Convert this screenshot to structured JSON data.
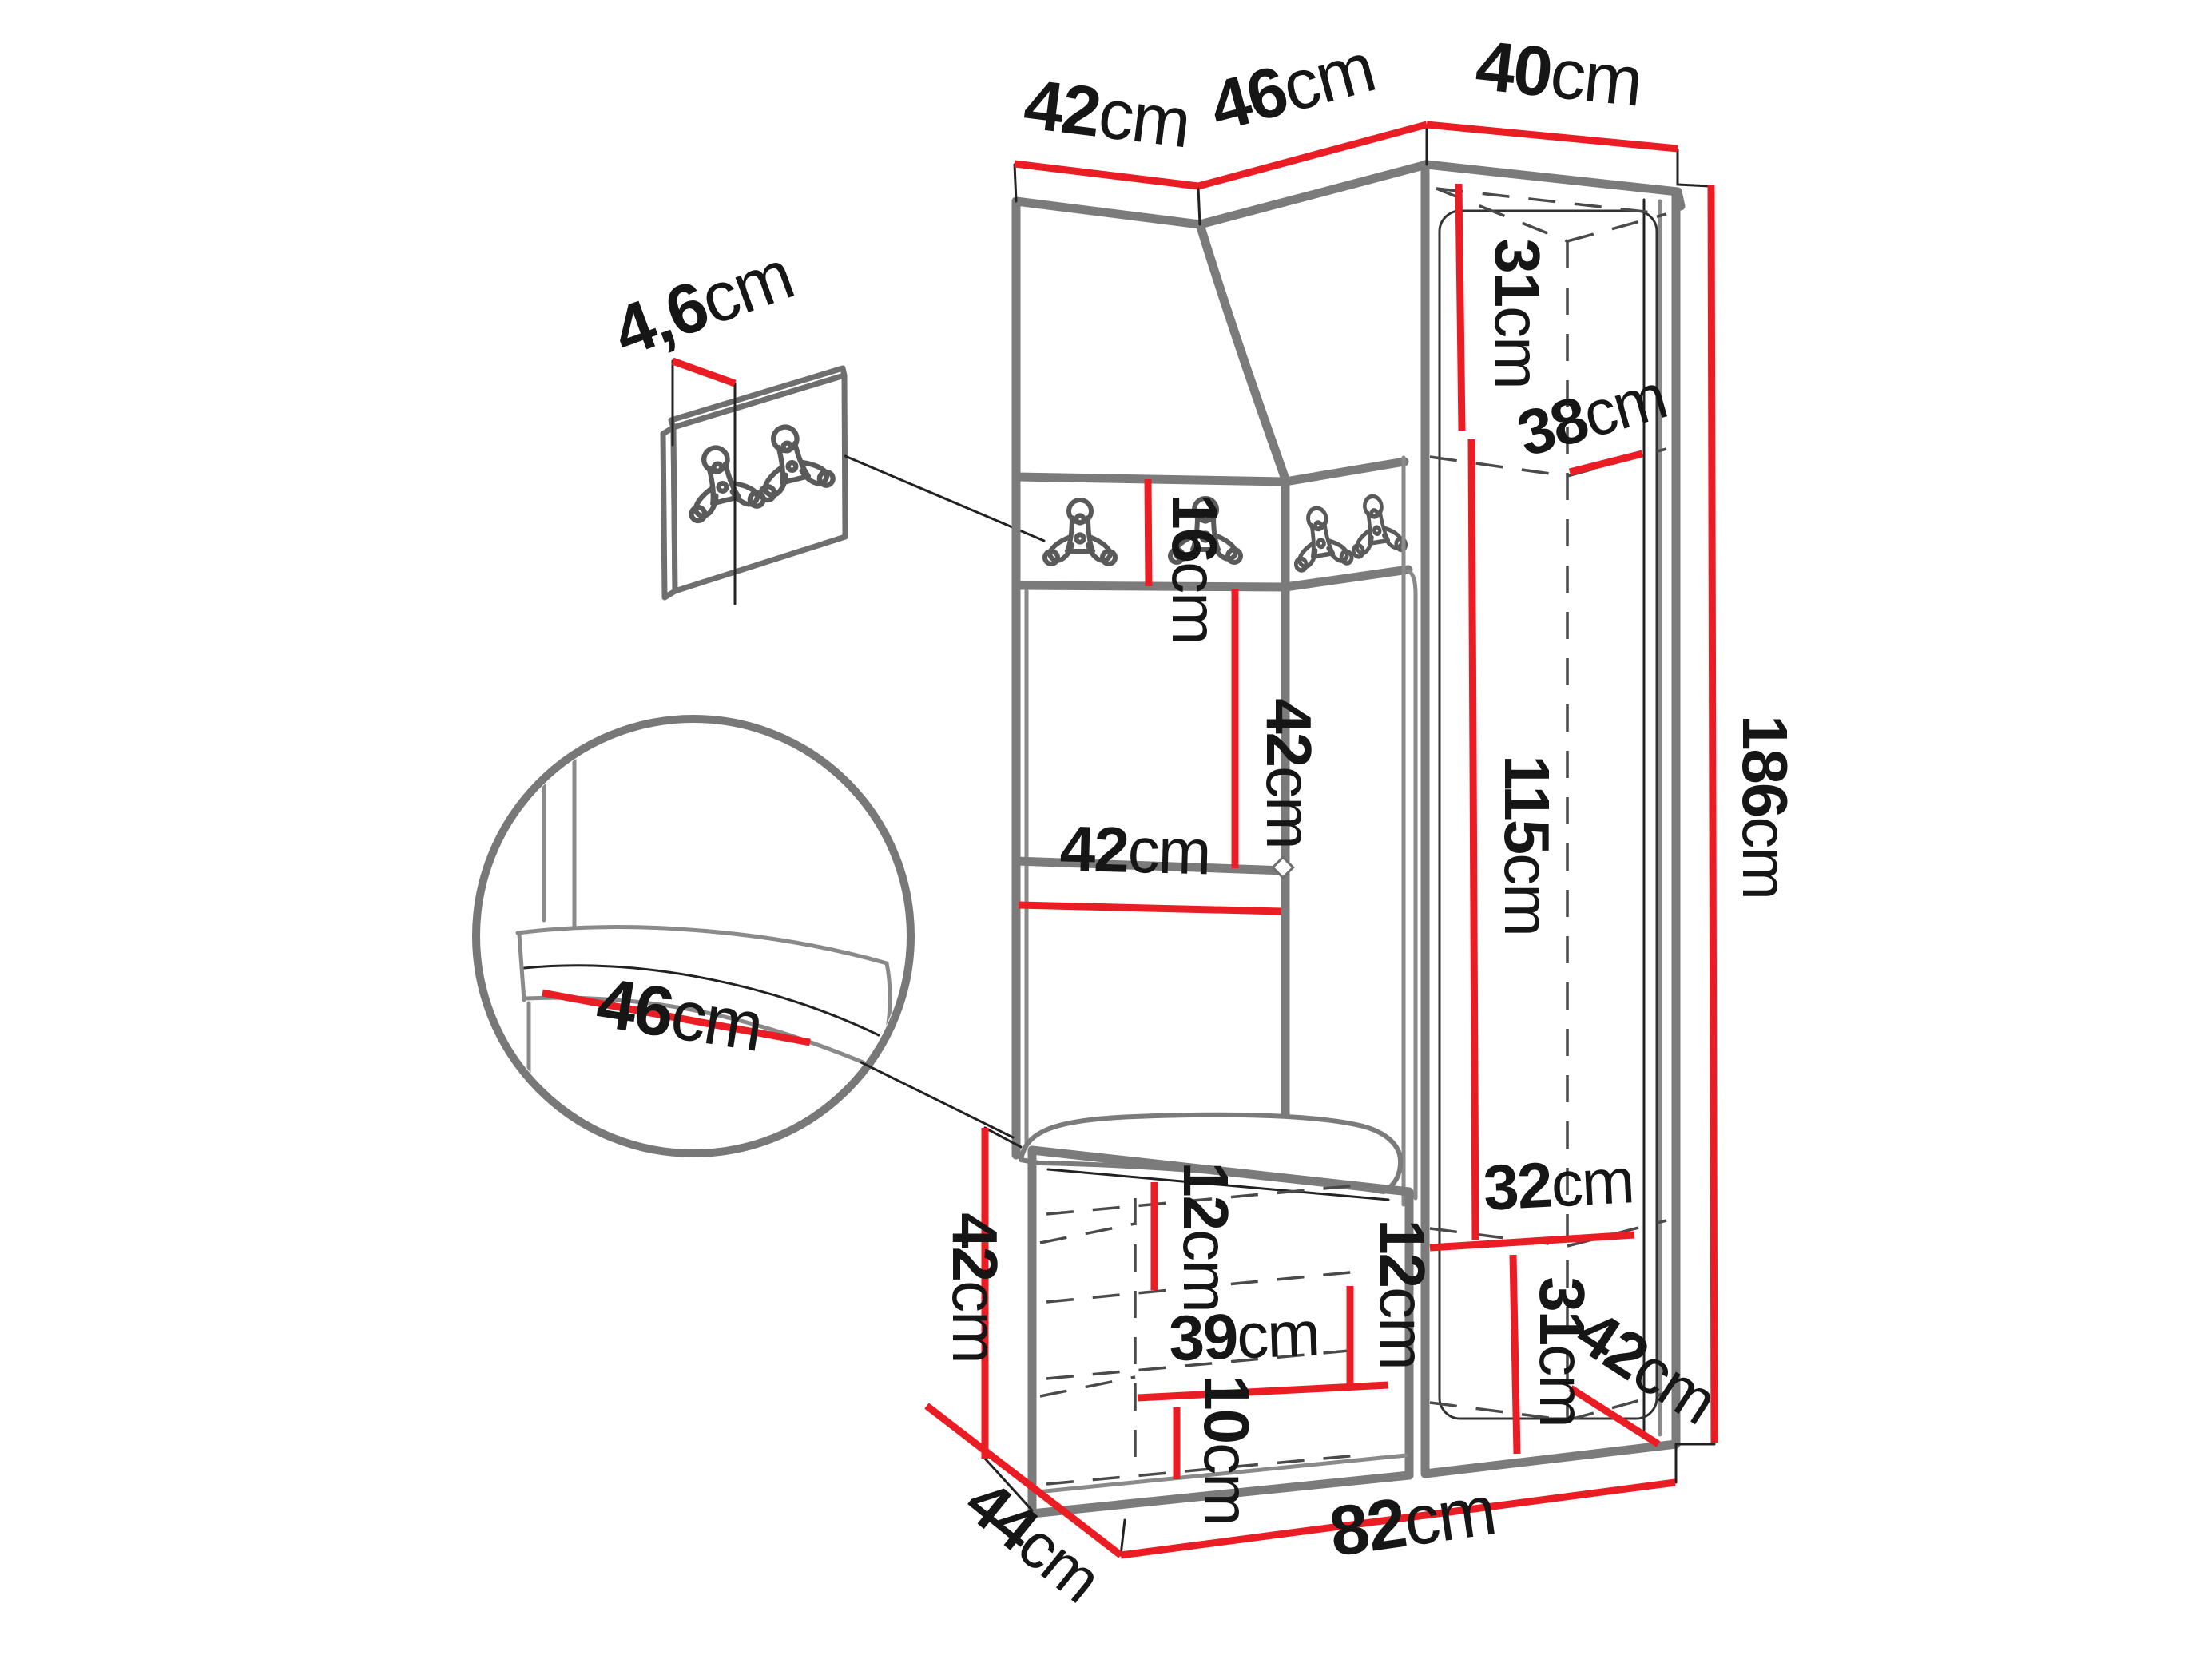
{
  "diagram": {
    "type": "furniture-dimension-diagram",
    "subject": "hallway-wardrobe-set-with-corner-cabinet-hook-panel-and-bench",
    "unit": "cm",
    "colors": {
      "dimension_line": "#ea1d25",
      "outline": "#7b7b7b",
      "hidden_edge": "#4a4a4a",
      "text": "#161616",
      "background": "#ffffff"
    },
    "icons": {
      "coat_hook": "double-coat-hook-icon",
      "tuft": "upholstery-button-diamond"
    },
    "dimensions": {
      "top_width_left": {
        "num": "42",
        "unit": "cm",
        "label": "42cm",
        "meaning": "top width of left wall panel"
      },
      "top_width_middle": {
        "num": "46",
        "unit": "cm",
        "label": "46cm",
        "meaning": "top width of angled corner panel"
      },
      "top_width_right": {
        "num": "40",
        "unit": "cm",
        "label": "40cm",
        "meaning": "top width of tall cabinet"
      },
      "panel_thickness": {
        "num": "4,6",
        "unit": "cm",
        "label": "4,6cm",
        "meaning": "hook panel thickness"
      },
      "hook_strip_height": {
        "num": "16",
        "unit": "cm",
        "label": "16cm",
        "meaning": "hook strip height"
      },
      "niche_height": {
        "num": "42",
        "unit": "cm",
        "label": "42cm",
        "meaning": "open niche height"
      },
      "niche_width": {
        "num": "42",
        "unit": "cm",
        "label": "42cm",
        "meaning": "open niche width"
      },
      "cabinet_top_height": {
        "num": "31",
        "unit": "cm",
        "label": "31cm",
        "meaning": "cabinet top compartment height"
      },
      "cabinet_depth": {
        "num": "38",
        "unit": "cm",
        "label": "38cm",
        "meaning": "cabinet inner depth"
      },
      "hanging_height": {
        "num": "115",
        "unit": "cm",
        "label": "115cm",
        "meaning": "hanging compartment height"
      },
      "total_height": {
        "num": "186",
        "unit": "cm",
        "label": "186cm",
        "meaning": "total height"
      },
      "seat_width": {
        "num": "46",
        "unit": "cm",
        "label": "46cm",
        "meaning": "seat cushion width (detail)"
      },
      "bench_height": {
        "num": "42",
        "unit": "cm",
        "label": "42cm",
        "meaning": "bench height"
      },
      "bench_top_inset": {
        "num": "12",
        "unit": "cm",
        "label": "12cm",
        "meaning": "bench top compartment height"
      },
      "bench_shelf_width": {
        "num": "39",
        "unit": "cm",
        "label": "39cm",
        "meaning": "bench shelf width"
      },
      "bench_bottom_height": {
        "num": "10",
        "unit": "cm",
        "label": "10cm",
        "meaning": "bench bottom space height"
      },
      "bench_shelf_gap": {
        "num": "12",
        "unit": "cm",
        "label": "12cm",
        "meaning": "bench shelf spacing"
      },
      "cabinet_shelf_width": {
        "num": "32",
        "unit": "cm",
        "label": "32cm",
        "meaning": "cabinet bottom shelf width"
      },
      "cabinet_bottom_height": {
        "num": "31",
        "unit": "cm",
        "label": "31cm",
        "meaning": "cabinet bottom compartment height"
      },
      "cabinet_bottom_depth": {
        "num": "42",
        "unit": "cm",
        "label": "42cm",
        "meaning": "cabinet bottom depth"
      },
      "bench_depth": {
        "num": "44",
        "unit": "cm",
        "label": "44cm",
        "meaning": "bench depth"
      },
      "total_width": {
        "num": "82",
        "unit": "cm",
        "label": "82cm",
        "meaning": "total width of base"
      }
    }
  }
}
